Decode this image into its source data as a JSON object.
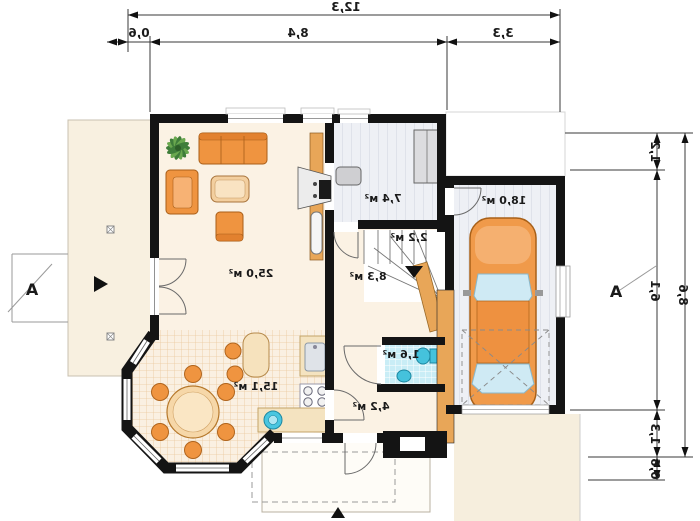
{
  "plan": {
    "rooms": [
      {
        "id": "living-room",
        "area_label": "25,0 м²"
      },
      {
        "id": "dining-kitchen",
        "area_label": "15,1 м²"
      },
      {
        "id": "vestibule",
        "area_label": "7,4 м²"
      },
      {
        "id": "stairs",
        "area_label": "2,2 м²"
      },
      {
        "id": "hall",
        "area_label": "8,3 м²"
      },
      {
        "id": "wc",
        "area_label": "1,6 м²"
      },
      {
        "id": "entry-corridor",
        "area_label": "4,2 м²"
      },
      {
        "id": "garage",
        "area_label": "18,0 м²"
      }
    ],
    "dimensions_top": {
      "total": "12,3",
      "segments": [
        "0,6",
        "8,4",
        "3,3"
      ]
    },
    "dimensions_right": {
      "total": "8,6",
      "segments": [
        "1,2",
        "6,1",
        "1,3",
        "0,6"
      ]
    },
    "section_marker_left": "A",
    "section_marker_right": "A",
    "colors": {
      "wall": "#141414",
      "masonry_wall": "#e8a658",
      "furniture": "#ef9440",
      "floor_cream": "#fbf2e4",
      "tile_line": "#eac99e",
      "wet_room_tile": "#c9edf6",
      "fixture_teal": "#45c2dc",
      "car_body": "#f09a4a",
      "glass_blue": "#cfeaf4"
    }
  }
}
